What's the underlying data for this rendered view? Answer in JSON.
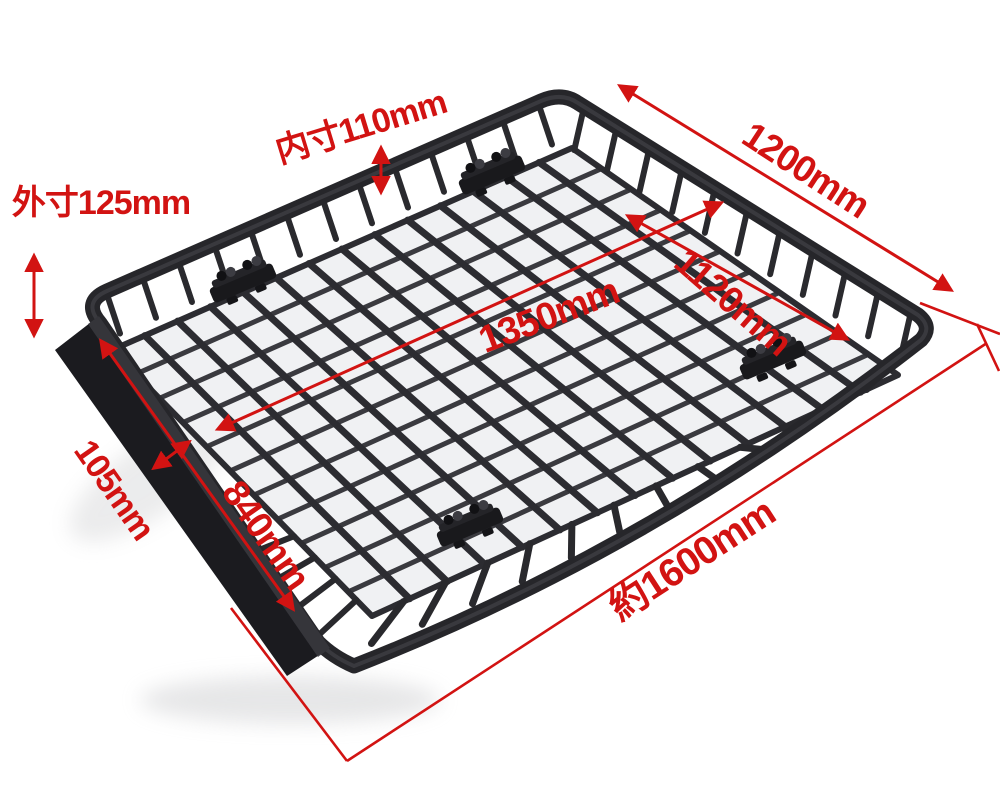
{
  "background_color": "#ffffff",
  "product_color": "#26262a",
  "annotation_color": "#d21312",
  "dimensions": {
    "inner_height": "内寸110mm",
    "outer_height": "外寸125mm",
    "rear_edge_length": "1200mm",
    "inner_width": "1120mm",
    "inner_length": "1350mm",
    "fairing_width": "105mm",
    "side_width": "840mm",
    "overall_length": "約1600mm"
  }
}
